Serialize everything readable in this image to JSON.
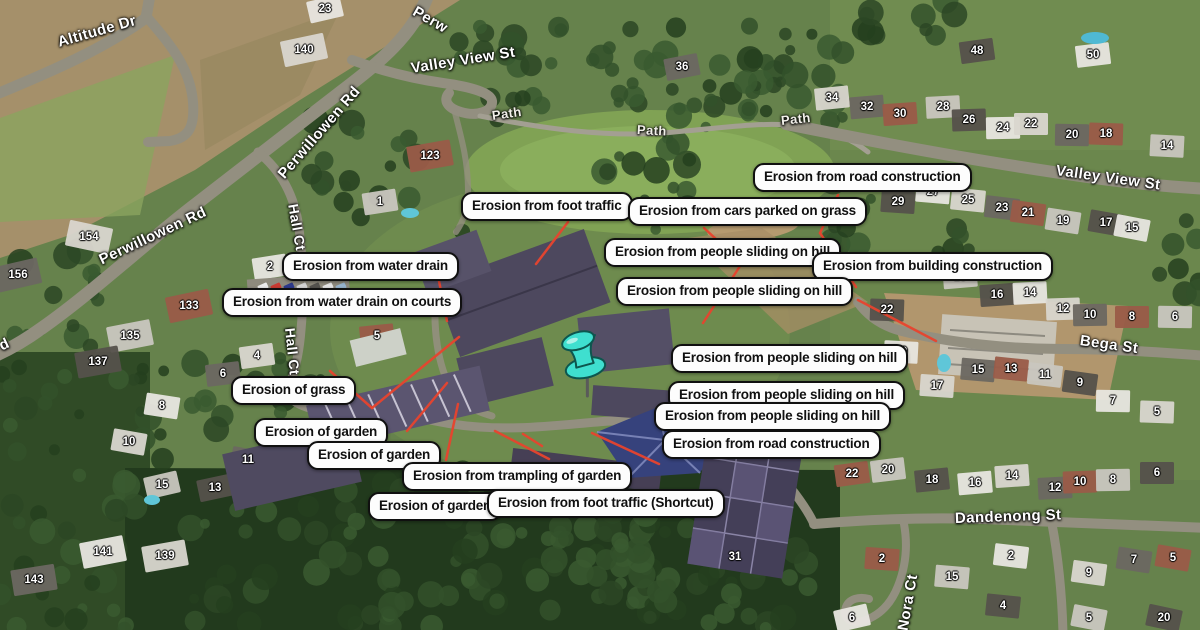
{
  "map": {
    "view_type": "satellite",
    "label_bg": "#fdfdfd",
    "label_border": "#101010",
    "red_line_color": "#e8442e"
  },
  "marker": {
    "name": "cyan-pushpin",
    "color": "#3fdfcf",
    "x": 583,
    "y": 356
  },
  "annotations": [
    {
      "text": "Erosion from road construction",
      "x": 753,
      "y": 163
    },
    {
      "text": "Erosion from foot traffic",
      "x": 461,
      "y": 192
    },
    {
      "text": "Erosion from cars parked on grass",
      "x": 628,
      "y": 197
    },
    {
      "text": "Erosion from people sliding on hill",
      "x": 604,
      "y": 238
    },
    {
      "text": "Erosion from building construction",
      "x": 812,
      "y": 252
    },
    {
      "text": "Erosion from people sliding on hill",
      "x": 616,
      "y": 277
    },
    {
      "text": "Erosion from water drain",
      "x": 282,
      "y": 252
    },
    {
      "text": "Erosion from water drain on courts",
      "x": 222,
      "y": 288
    },
    {
      "text": "Erosion from people sliding on hill",
      "x": 671,
      "y": 344
    },
    {
      "text": "Erosion from people sliding on hill",
      "x": 668,
      "y": 381
    },
    {
      "text": "Erosion from people sliding on hill",
      "x": 654,
      "y": 402
    },
    {
      "text": "Erosion from road construction",
      "x": 662,
      "y": 430
    },
    {
      "text": "Erosion of grass",
      "x": 231,
      "y": 376
    },
    {
      "text": "Erosion of garden",
      "x": 254,
      "y": 418
    },
    {
      "text": "Erosion of garden",
      "x": 307,
      "y": 441
    },
    {
      "text": "Erosion from trampling of garden",
      "x": 402,
      "y": 462
    },
    {
      "text": "Erosion of garden",
      "x": 368,
      "y": 492
    },
    {
      "text": "Erosion from foot traffic (Shortcut)",
      "x": 487,
      "y": 489
    }
  ],
  "streets": [
    {
      "name": "Altitude Dr",
      "x": 58,
      "y": 34,
      "r": -16,
      "fs": 15
    },
    {
      "name": "Perw",
      "x": 414,
      "y": 2,
      "r": 30,
      "fs": 15
    },
    {
      "name": "Perwillowen Rd",
      "x": 281,
      "y": 168,
      "r": -49,
      "fs": 15
    },
    {
      "name": "Valley View St",
      "x": 411,
      "y": 60,
      "r": -9,
      "fs": 15
    },
    {
      "name": "Path",
      "x": 492,
      "y": 108,
      "r": -8,
      "fs": 13
    },
    {
      "name": "Path",
      "x": 637,
      "y": 122,
      "r": 3,
      "fs": 13
    },
    {
      "name": "Path",
      "x": 781,
      "y": 113,
      "r": -6,
      "fs": 13
    },
    {
      "name": "Valley View St",
      "x": 1056,
      "y": 162,
      "r": 8,
      "fs": 15
    },
    {
      "name": "Perwillowen Rd",
      "x": 100,
      "y": 252,
      "r": -25,
      "fs": 15
    },
    {
      "name": "Hall Ct",
      "x": 293,
      "y": 196,
      "r": 80,
      "fs": 14
    },
    {
      "name": "Hall Ct",
      "x": 290,
      "y": 320,
      "r": 84,
      "fs": 14
    },
    {
      "name": "Bega St",
      "x": 1080,
      "y": 332,
      "r": 8,
      "fs": 15
    },
    {
      "name": "Dandenong St",
      "x": 955,
      "y": 510,
      "r": -2,
      "fs": 15
    },
    {
      "name": "Nora Ct",
      "x": 903,
      "y": 622,
      "r": -80,
      "fs": 15
    },
    {
      "name": "d",
      "x": 0,
      "y": 338,
      "r": -25,
      "fs": 15
    }
  ],
  "house_numbers": [
    [
      "23",
      325,
      9
    ],
    [
      "140",
      304,
      50
    ],
    [
      "36",
      682,
      67
    ],
    [
      "123",
      430,
      156
    ],
    [
      "1",
      380,
      202
    ],
    [
      "48",
      977,
      51
    ],
    [
      "50",
      1093,
      55
    ],
    [
      "34",
      832,
      98
    ],
    [
      "32",
      867,
      107
    ],
    [
      "30",
      900,
      114
    ],
    [
      "28",
      943,
      107
    ],
    [
      "26",
      969,
      120
    ],
    [
      "24",
      1003,
      128
    ],
    [
      "22",
      1031,
      124
    ],
    [
      "20",
      1072,
      135
    ],
    [
      "18",
      1106,
      134
    ],
    [
      "14",
      1167,
      146
    ],
    [
      "29",
      898,
      202
    ],
    [
      "27",
      933,
      192
    ],
    [
      "25",
      968,
      200
    ],
    [
      "23",
      1002,
      208
    ],
    [
      "21",
      1028,
      213
    ],
    [
      "19",
      1063,
      221
    ],
    [
      "17",
      1106,
      223
    ],
    [
      "15",
      1132,
      228
    ],
    [
      "154",
      89,
      237
    ],
    [
      "156",
      18,
      275
    ],
    [
      "133",
      189,
      306
    ],
    [
      "135",
      130,
      336
    ],
    [
      "137",
      98,
      362
    ],
    [
      "2",
      270,
      267
    ],
    [
      "4",
      257,
      356
    ],
    [
      "6",
      223,
      374
    ],
    [
      "5",
      377,
      336
    ],
    [
      "18",
      960,
      277
    ],
    [
      "16",
      997,
      295
    ],
    [
      "14",
      1030,
      293
    ],
    [
      "12",
      1063,
      309
    ],
    [
      "10",
      1090,
      315
    ],
    [
      "8",
      1132,
      317
    ],
    [
      "6",
      1175,
      317
    ],
    [
      "22",
      887,
      310
    ],
    [
      "19",
      901,
      352
    ],
    [
      "17",
      937,
      386
    ],
    [
      "15",
      978,
      370
    ],
    [
      "13",
      1011,
      369
    ],
    [
      "11",
      1045,
      375
    ],
    [
      "9",
      1080,
      383
    ],
    [
      "8",
      162,
      406
    ],
    [
      "10",
      129,
      442
    ],
    [
      "11",
      248,
      460
    ],
    [
      "9",
      282,
      440
    ],
    [
      "15",
      162,
      485
    ],
    [
      "13",
      215,
      488
    ],
    [
      "141",
      103,
      552
    ],
    [
      "139",
      165,
      556
    ],
    [
      "143",
      34,
      580
    ],
    [
      "22",
      852,
      474
    ],
    [
      "20",
      888,
      470
    ],
    [
      "18",
      932,
      480
    ],
    [
      "16",
      975,
      483
    ],
    [
      "14",
      1012,
      476
    ],
    [
      "12",
      1055,
      488
    ],
    [
      "10",
      1080,
      482
    ],
    [
      "8",
      1113,
      480
    ],
    [
      "6",
      1157,
      473
    ],
    [
      "7",
      1113,
      401
    ],
    [
      "5",
      1157,
      412
    ],
    [
      "31",
      735,
      557
    ],
    [
      "2",
      882,
      559
    ],
    [
      "15",
      952,
      577
    ],
    [
      "4",
      1003,
      606
    ],
    [
      "2",
      1011,
      556
    ],
    [
      "9",
      1089,
      573
    ],
    [
      "7",
      1134,
      560
    ],
    [
      "5",
      1173,
      558
    ],
    [
      "5",
      1089,
      618
    ],
    [
      "20",
      1164,
      618
    ],
    [
      "6",
      852,
      618
    ]
  ],
  "red_lines": [
    [
      568,
      222,
      536,
      264
    ],
    [
      704,
      228,
      742,
      263
    ],
    [
      742,
      263,
      703,
      323
    ],
    [
      838,
      195,
      820,
      233
    ],
    [
      820,
      233,
      856,
      287
    ],
    [
      858,
      300,
      936,
      341
    ],
    [
      330,
      371,
      372,
      408
    ],
    [
      372,
      408,
      459,
      337
    ],
    [
      407,
      431,
      447,
      383
    ],
    [
      458,
      404,
      446,
      460
    ],
    [
      495,
      431,
      549,
      459
    ],
    [
      523,
      434,
      542,
      446
    ],
    [
      592,
      433,
      659,
      464
    ],
    [
      437,
      271,
      447,
      321
    ],
    [
      441,
      294,
      410,
      310
    ]
  ]
}
